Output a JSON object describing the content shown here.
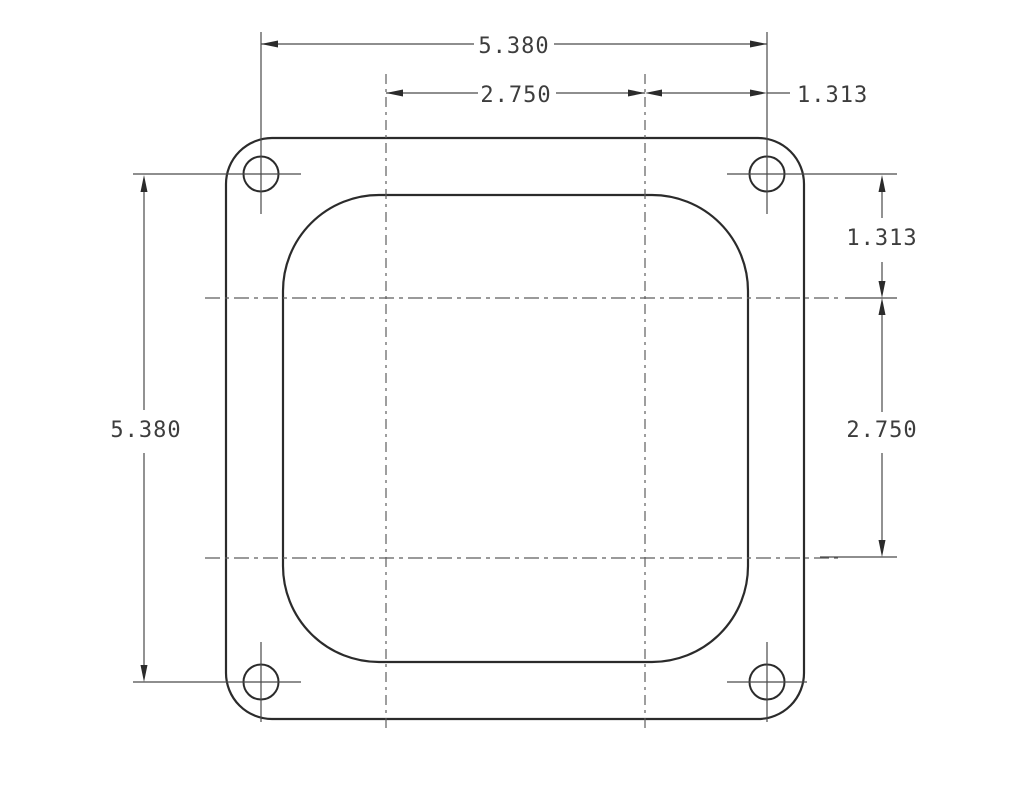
{
  "drawing": {
    "type": "technical-drawing",
    "subject": "square four-bolt flange plate with rounded-square bore",
    "background_color": "#ffffff",
    "outline_color": "#2b2b2b",
    "dimension_line_color": "#4a4a4a",
    "text_color": "#3d3d3d",
    "dimensions": {
      "top_overall_width": "5.380",
      "top_bore_span": "2.750",
      "top_right_offset": "1.313",
      "right_upper_offset": "1.313",
      "right_bore_span": "2.750",
      "left_overall_height": "5.380"
    }
  }
}
